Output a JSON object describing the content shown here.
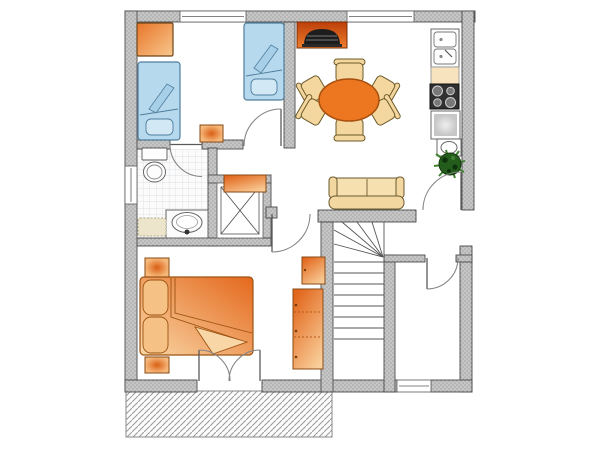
{
  "meta": {
    "type": "floor-plan",
    "description": "Top-down architectural floor plan of an apartment"
  },
  "colors": {
    "bg": "#ffffff",
    "wall_fill": "#c6c6c6",
    "wall_dot": "#8f8f8f",
    "wall_edge": "#4a4a4a",
    "line": "#555555",
    "door": "#858585",
    "window_fill": "#ffffff",
    "bed_blue": "#b6d9ed",
    "bed_blue_fold": "#a7cfe8",
    "bed_blue_pillow": "#d2e8f5",
    "bed_blue_edge": "#4f7d9e",
    "orange_dark": "#d95f14",
    "orange_mid": "#e8752a",
    "orange_light": "#f8c88d",
    "orange_edge": "#8a4a12",
    "table_orange": "#ed7621",
    "table_edge": "#a8500f",
    "chair_beige": "#f4d79e",
    "chair_edge": "#6b5a28",
    "sofa_cream": "#f6e0b0",
    "sofa_dark": "#f2d7a0",
    "sofa_edge": "#6b5a30",
    "fireplace_top": "#bc3f09",
    "fireplace_bottom": "#ef7e2d",
    "stove_black": "#1d1d1d",
    "fixture_white": "#fdfdfd",
    "fixture_edge": "#5a5a5a",
    "counter_beige": "#f7e3bd",
    "stove_dark": "#303030",
    "burner": "#787878",
    "mat": "#ece5cc",
    "mat_edge": "#b0a888",
    "plant_dark": "#245c1c",
    "plant_deep": "#0d330b",
    "plant_light": "#3f8230",
    "tile_line": "#d4dade",
    "hatch_line": "#9a9a9a",
    "hatch_edge": "#8a8a8a",
    "stair_line": "#555555",
    "pillow_orange": "#f5c184",
    "pillow_orange_edge": "#9c5312"
  },
  "counts": {
    "dining_chairs": 6,
    "stair_treads": 8,
    "windows": 4,
    "door_swings": 7,
    "kitchen_units": 5
  },
  "objects": {
    "bedroom_top_left": [
      "wardrobe",
      "single-bed",
      "single-bed",
      "side-table"
    ],
    "dining_kitchen": [
      "fireplace-stove",
      "dining-table",
      "dining-chairs",
      "double-sink",
      "counter",
      "cooktop",
      "appliance",
      "hand-basin",
      "potted-plant"
    ],
    "bathroom": [
      "toilet",
      "vanity-basin",
      "bath-mat",
      "shower-cabin",
      "dresser"
    ],
    "living_area": [
      "sofa",
      "half-wall",
      "entry-door"
    ],
    "bedroom_bottom_left": [
      "double-bed",
      "nightstand",
      "nightstand",
      "small-cabinet",
      "tall-wardrobe",
      "french-doors"
    ],
    "stair_hall": [
      "winder-staircase"
    ],
    "room_bottom_right": [],
    "exterior": [
      "terrace"
    ]
  }
}
